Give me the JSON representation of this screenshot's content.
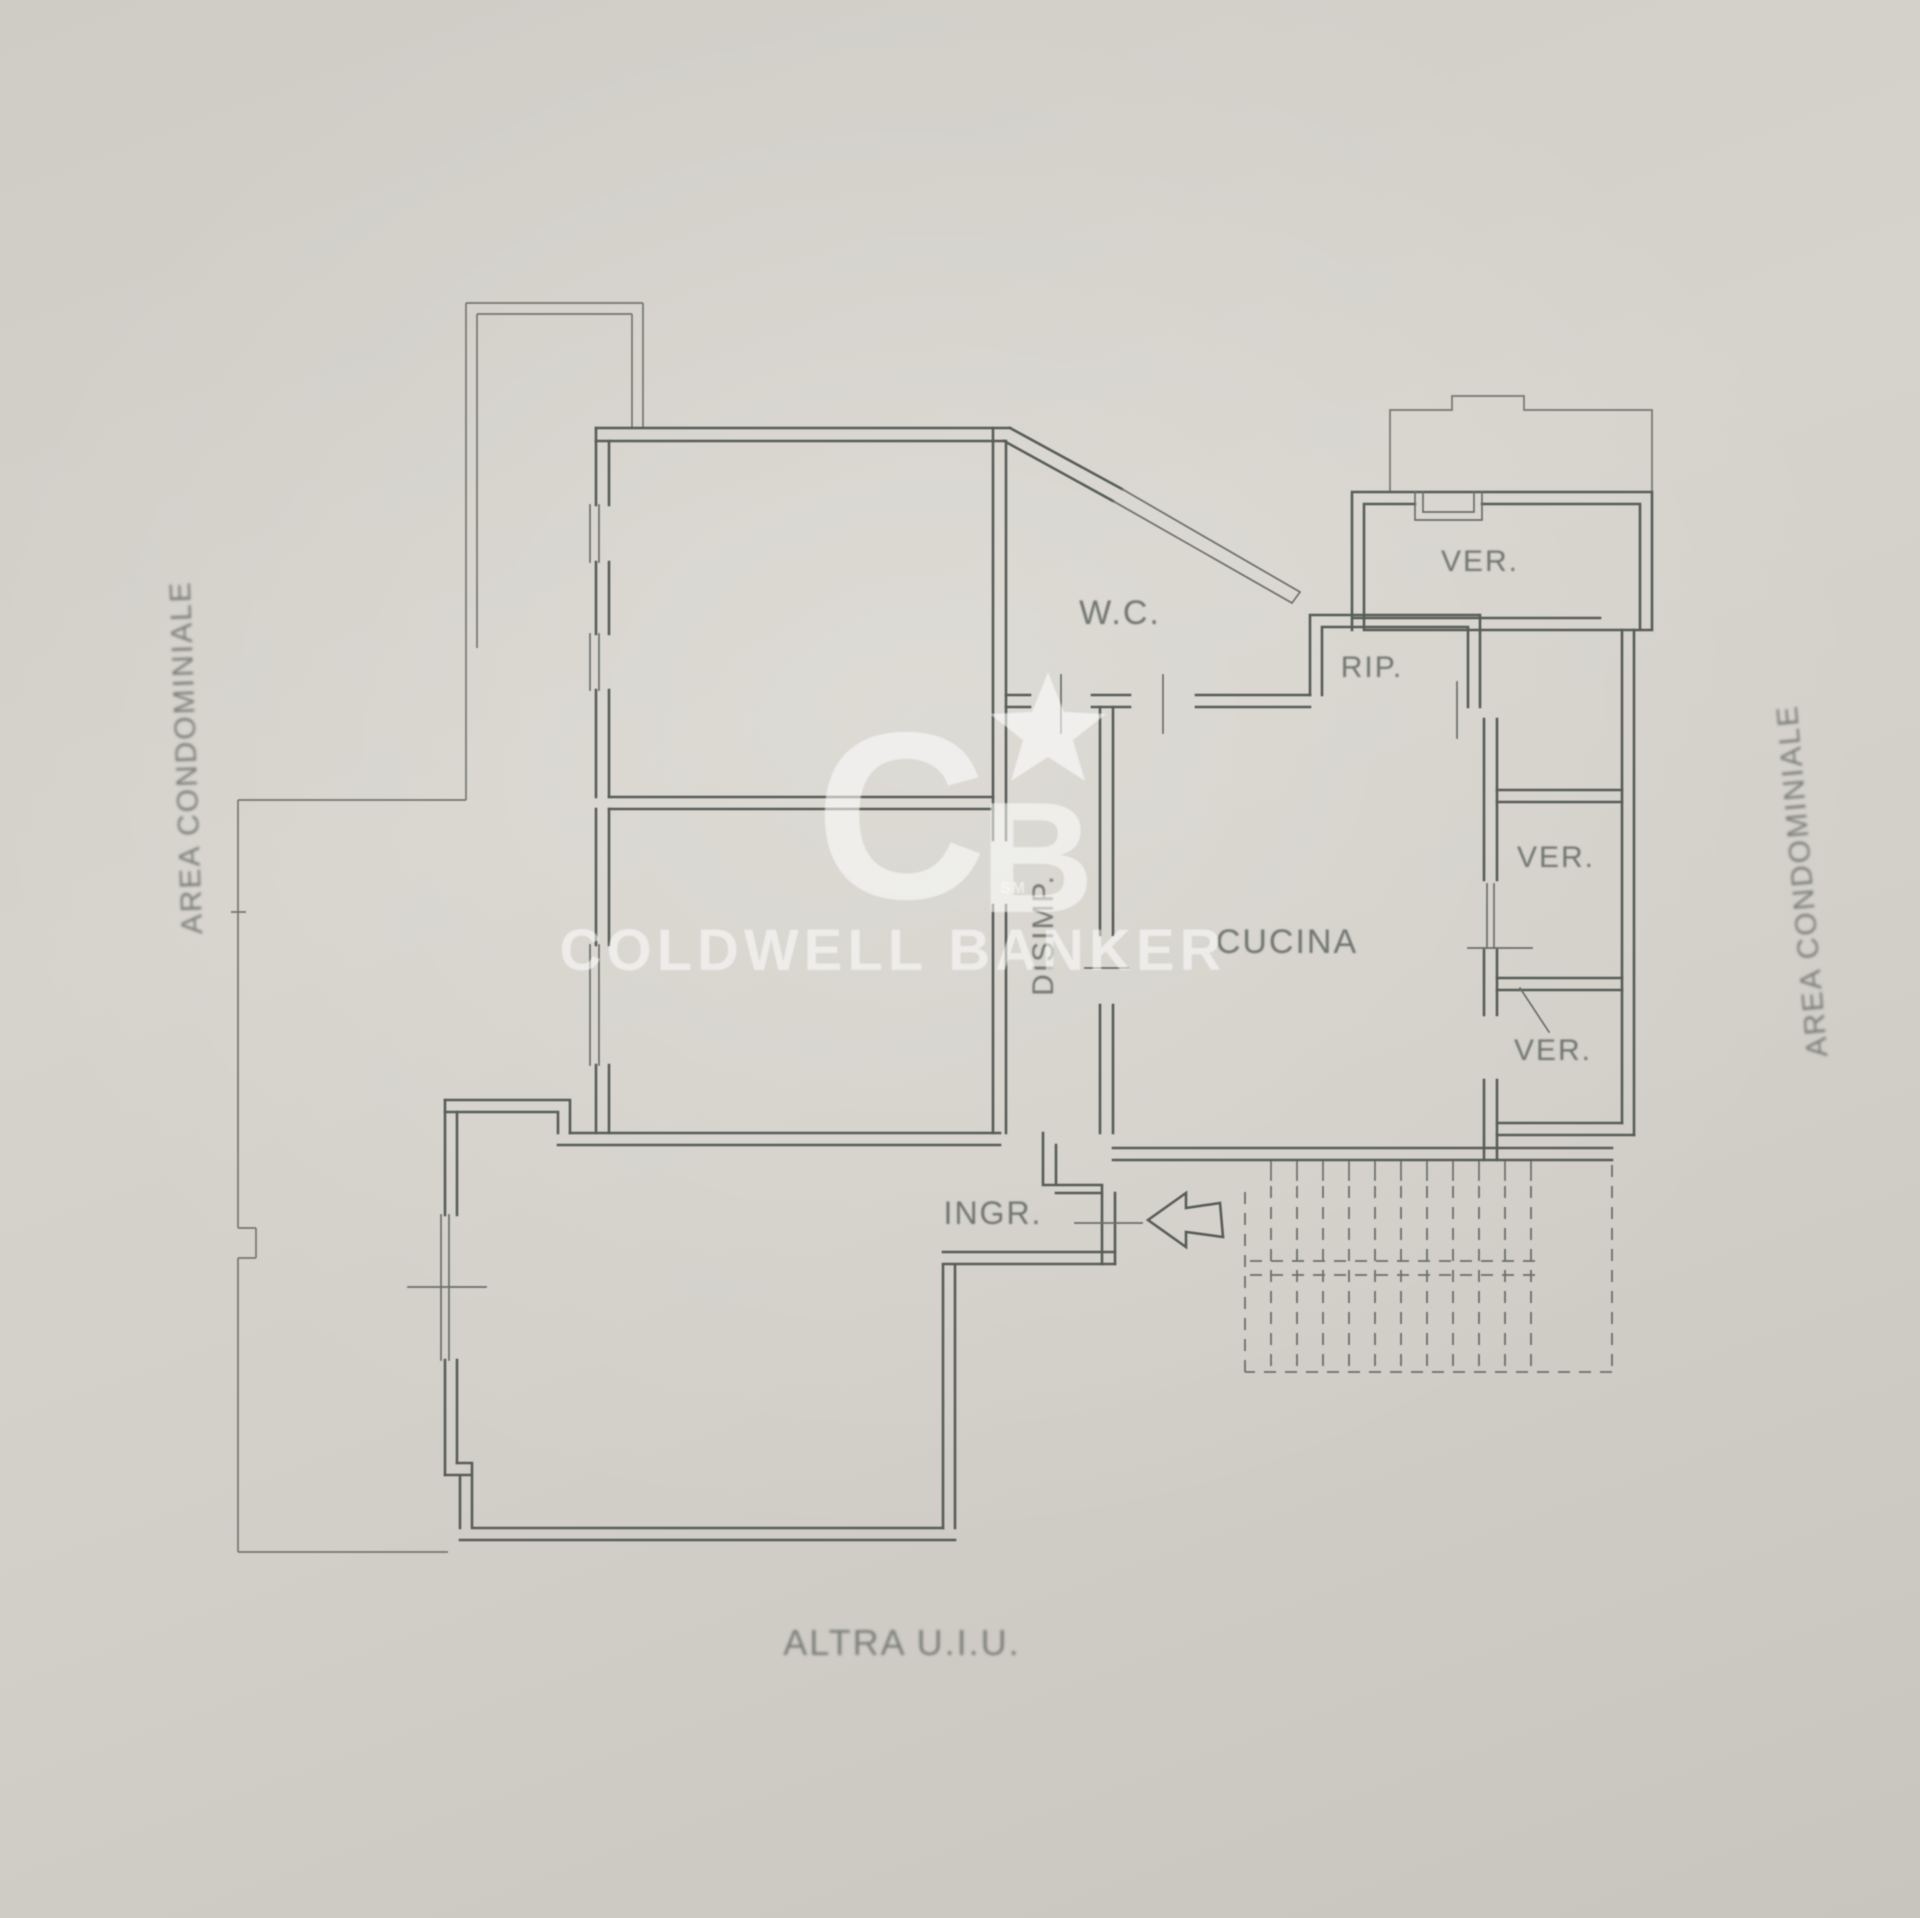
{
  "page": {
    "kind": "floor-plan-photo",
    "background_color": "#d2cfc8",
    "line_color": "#585d58",
    "label_color": "#70746f"
  },
  "floor_plan": {
    "rooms": [
      {
        "id": "wc",
        "label": "W.C."
      },
      {
        "id": "rip",
        "label": "RIP."
      },
      {
        "id": "ver_top",
        "label": "VER."
      },
      {
        "id": "ver_mid",
        "label": "VER."
      },
      {
        "id": "ver_low",
        "label": "VER."
      },
      {
        "id": "cucina",
        "label": "CUCINA"
      },
      {
        "id": "disimp",
        "label": "DISIMP."
      },
      {
        "id": "ingr",
        "label": "INGR."
      }
    ],
    "annotations": {
      "area_condominiale_left": "AREA CONDOMINIALE",
      "area_condominiale_right": "AREA CONDOMINIALE",
      "other_unit": "ALTRA U.I.U."
    },
    "features": {
      "entrance_arrow": "left-pointing entrance arrow",
      "staircase": "dashed external staircase"
    }
  },
  "watermark": {
    "logo_c": "C",
    "logo_b": "B",
    "logo_sm": "SM",
    "brand": "COLDWELL BANKER",
    "color": "#ffffff"
  }
}
